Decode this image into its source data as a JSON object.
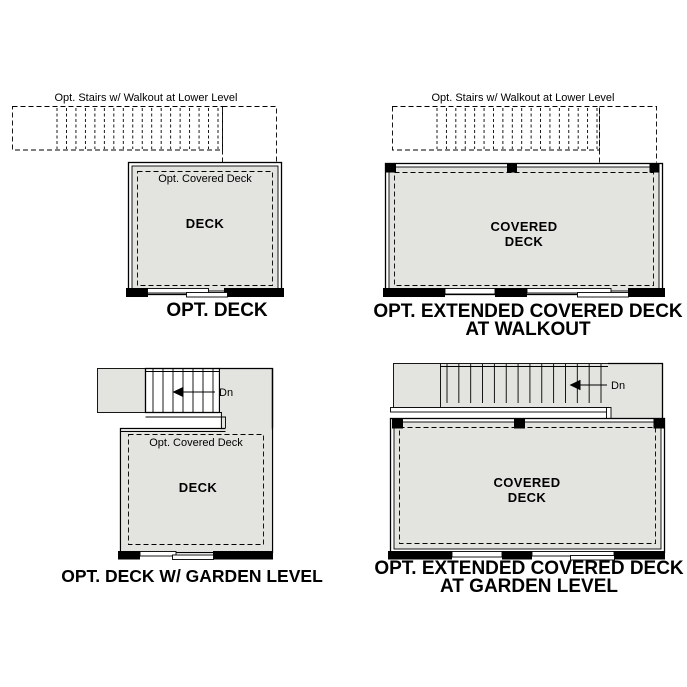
{
  "colors": {
    "deck_fill": "#e3e3e0",
    "line": "#000000",
    "background": "#ffffff"
  },
  "panels": {
    "opt_deck": {
      "stairs_label": "Opt. Stairs w/ Walkout at Lower Level",
      "covered_label": "Opt. Covered Deck",
      "deck_label": "DECK",
      "title": "OPT. DECK"
    },
    "extended_walkout": {
      "stairs_label": "Opt. Stairs w/ Walkout at Lower Level",
      "deck_label_line1": "COVERED",
      "deck_label_line2": "DECK",
      "title_line1": "OPT. EXTENDED COVERED DECK",
      "title_line2": "AT WALKOUT"
    },
    "deck_garden": {
      "down_label": "Dn",
      "covered_label": "Opt. Covered Deck",
      "deck_label": "DECK",
      "title": "OPT. DECK W/ GARDEN LEVEL"
    },
    "extended_garden": {
      "down_label": "Dn",
      "deck_label_line1": "COVERED",
      "deck_label_line2": "DECK",
      "title_line1": "OPT. EXTENDED COVERED DECK",
      "title_line2": "AT GARDEN LEVEL"
    }
  }
}
